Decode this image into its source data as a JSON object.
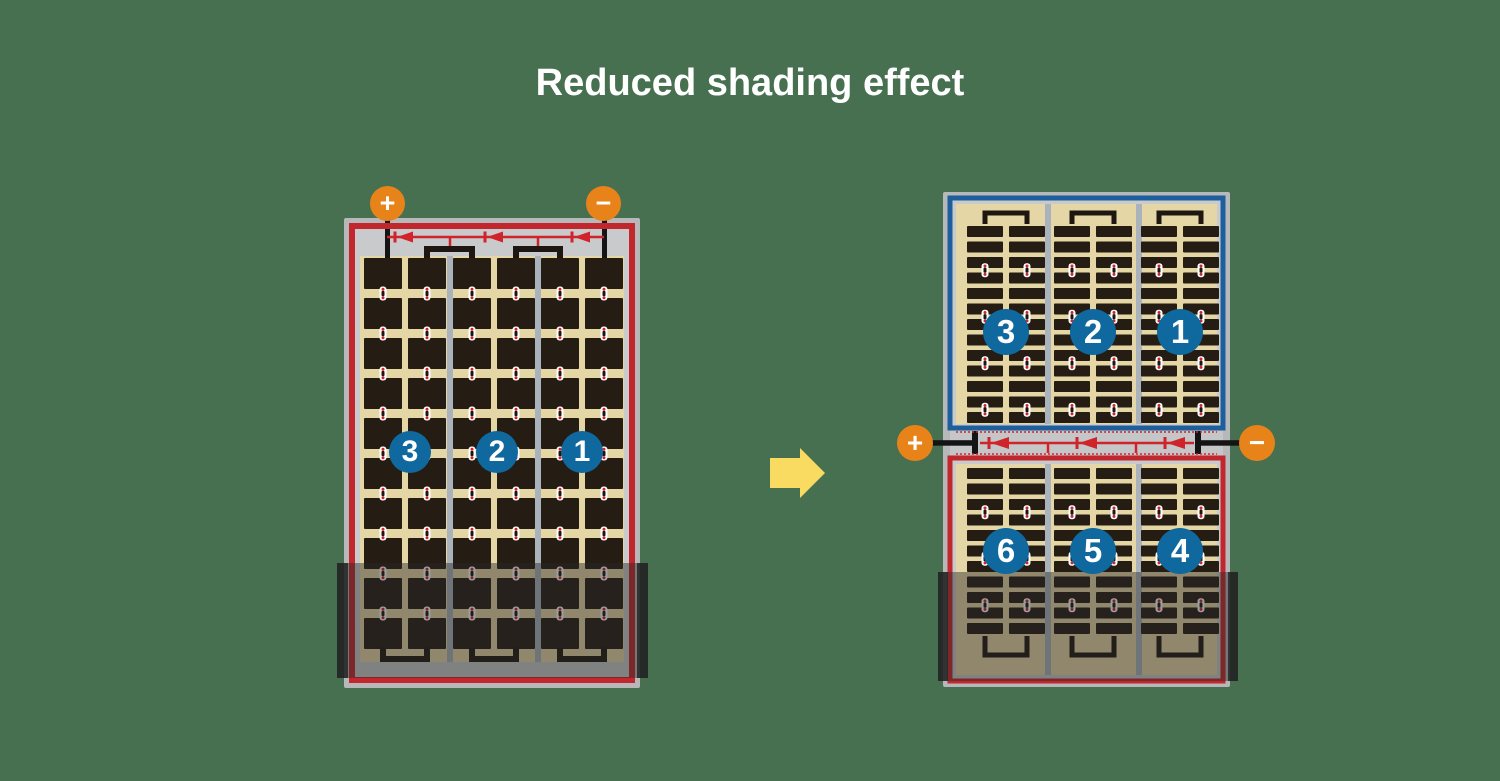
{
  "title": "Reduced shading effect",
  "left_panel": {
    "terminal_plus": "+",
    "terminal_minus": "−",
    "section_labels": [
      "3",
      "2",
      "1"
    ]
  },
  "right_panel": {
    "terminal_plus": "+",
    "terminal_minus": "−",
    "top_section_labels": [
      "3",
      "2",
      "1"
    ],
    "bottom_section_labels": [
      "6",
      "5",
      "4"
    ]
  },
  "colors": {
    "background": "#477050",
    "title_text": "#FFFFFF",
    "panel_frame_gray": "#B6B8BA",
    "panel_inner_gray": "#C9CACB",
    "junction_strip_gray": "#C4C6C8",
    "cell_background_tan": "#E5D6A6",
    "cell_dark": "#251C13",
    "divider_gray": "#AAB3BC",
    "border_red": "#C1272D",
    "border_blue": "#1D5F9C",
    "diode_red": "#D1232A",
    "terminal_orange": "#E8831A",
    "number_circle_blue": "#0F689E",
    "label_text": "#FFFFFF",
    "arrow_yellow": "#F8DB60",
    "shade_overlay": "rgba(40,40,40,0.45)",
    "shade_edge": "rgba(33,33,33,0.8)",
    "busbar_black": "#1E1610",
    "wire_black": "#141414",
    "connector_white": "#FFFFFF"
  }
}
